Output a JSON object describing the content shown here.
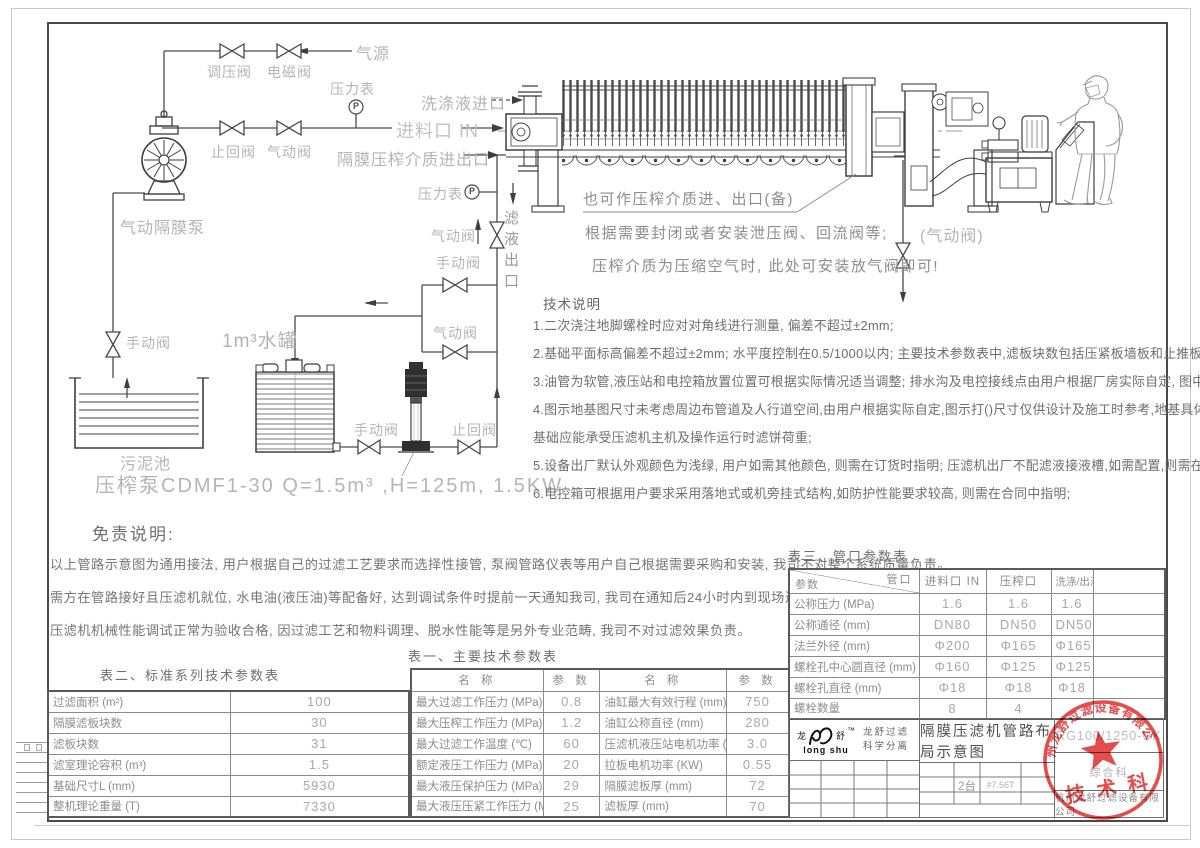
{
  "piping": {
    "gauge_letter": "P",
    "air_source": "气源",
    "regulator_valve": "调压阀",
    "solenoid_valve": "电磁阀",
    "pressure_gauge1": "压力表",
    "check_valve1": "止回阀",
    "pneumatic_valve1": "气动阀",
    "diaphragm_pump": "气动隔膜泵",
    "manual_valve_pool": "手动阀",
    "sludge_pool": "污泥池",
    "wash_inlet": "洗涤液进口",
    "feed_inlet": "进料口 IN",
    "membrane_port": "隔膜压榨介质进出口",
    "pressure_gauge2": "压力表",
    "pneumatic_valve2": "气动阀",
    "filtrate_outlet": "滤液出口",
    "manual_valve_branch": "手动阀",
    "pneumatic_valve_branch": "气动阀",
    "water_tank": "1m³水罐",
    "manual_valve_tank": "手动阀",
    "check_valve_bottom": "止回阀",
    "pneumatic_valve_right": "(气动阀)",
    "press_pump_spec": "压榨泵CDMF1-30   Q=1.5m³  ,H=125m, 1.5KW"
  },
  "callouts": {
    "c1": "也可作压榨介质进、出口(备)",
    "c2": "根据需要封闭或者安装泄压阀、回流阀等;",
    "c3": "压榨介质为压缩空气时, 此处可安装放气阀即可!"
  },
  "tech_notes": {
    "title": "技术说明",
    "lines": [
      "1.二次浇注地脚螺栓时应对对角线进行测量, 偏差不超过±2mm;",
      "2.基础平面标高偏差不超过±2mm; 水平度控制在0.5/1000以内; 主要技术参数表中,滤板块数包括压紧板墙板和止推板墙板;",
      "3.油管为软管,液压站和电控箱放置位置可根据实际情况适当调整;  排水沟及电控接线点由用户根据厂房实际自定, 图中不表示;",
      "4.图示地基图尺寸未考虑周边布管道及人行道空间,由用户根据实际自定,图示打()尺寸仅供设计及施工时参考,地基具体设计由用户负责,",
      "  基础应能承受压滤机主机及操作运行时滤饼荷重;",
      "5.设备出厂默认外观颜色为浅绿, 用户如需其他颜色, 则需在订货时指明; 压滤机出厂不配滤液接液槽,如需配置,则需在合同中指明。",
      "6.电控箱可根据用户要求采用落地式或机旁挂式结构,如防护性能要求较高, 则需在合同中指明;"
    ]
  },
  "disclaimer": {
    "title": "免责说明:",
    "lines": [
      "以上管路示意图为通用接法, 用户根据自己的过滤工艺要求而选择性接管, 泵阀管路仪表等用户自己根据需要采购和安装, 我司不对整个系统质量负责。",
      "需方在管路接好且压滤机就位, 水电油(液压油)等配备好, 达到调试条件时提前一天通知我司, 我司在通知后24小时内到现场进行压滤机各项动作调试,",
      "压滤机机械性能调试正常为验收合格, 因过滤工艺和物料调理、脱水性能等是另外专业范畴, 我司不对过滤效果负责。"
    ]
  },
  "table1": {
    "title": "表一、主要技术参数表",
    "headers": [
      "名  称",
      "参  数",
      "名  称",
      "参  数"
    ],
    "rows": [
      [
        "最大过滤工作压力 (MPa)",
        "0.8",
        "油缸最大有效行程 (mm)",
        "750"
      ],
      [
        "最大压榨工作压力 (MPa)",
        "1.2",
        "油缸公称直径 (mm)",
        "280"
      ],
      [
        "最大过滤工作温度 (℃)",
        "60",
        "压滤机液压站电机功率 (KW)",
        "3.0"
      ],
      [
        "额定液压工作压力 (MPa)",
        "20",
        "拉板电机功率 (KW)",
        "0.55"
      ],
      [
        "最大液压保护压力 (MPa)",
        "29",
        "隔膜滤板厚 (mm)",
        "72"
      ],
      [
        "最大液压压紧工作压力 (MPa)",
        "25",
        "滤板厚 (mm)",
        "70"
      ]
    ]
  },
  "table2": {
    "title": "表二、标准系列技术参数表",
    "rows": [
      [
        "过滤面积 (m²)",
        "100"
      ],
      [
        "隔膜滤板块数",
        "30"
      ],
      [
        "滤板块数",
        "31"
      ],
      [
        "滤室理论容积 (m³)",
        "1.5"
      ],
      [
        "基础尺寸L (mm)",
        "5930"
      ],
      [
        "整机理论重量 (T)",
        "7330"
      ]
    ]
  },
  "table3": {
    "title": "表三、管口参数表",
    "corner_top": "管口",
    "corner_bottom": "参数",
    "headers": [
      "进料口 IN",
      "压榨口",
      "洗涤/出液口",
      ""
    ],
    "rows": [
      [
        "公称压力 (MPa)",
        "1.6",
        "1.6",
        "1.6",
        ""
      ],
      [
        "公称通径 (mm)",
        "DN80",
        "DN50",
        "DN50",
        ""
      ],
      [
        "法兰外径 (mm)",
        "Φ200",
        "Φ165",
        "Φ165",
        ""
      ],
      [
        "螺栓孔中心圆直径 (mm)",
        "Φ160",
        "Φ125",
        "Φ125",
        ""
      ],
      [
        "螺栓孔直径 (mm)",
        "Φ18",
        "Φ18",
        "Φ18",
        ""
      ],
      [
        "螺栓数量",
        "8",
        "4",
        "",
        ""
      ]
    ]
  },
  "titleblock": {
    "logo_cn_left": "龙",
    "logo_cn_right": "舒",
    "logo_tm": "™",
    "logo_en": "long shu",
    "brand_line1": "龙舒过滤",
    "brand_line2": "科学分离",
    "title": "隔膜压滤机管路布局示意图",
    "drawing_no": "RG100/1250-UK",
    "dept": "综合科",
    "qty": "2台",
    "weight": "#7.56T",
    "company": "杭州龙舒过滤设备有限公司"
  },
  "stamp": {
    "ring_text": "杭州龙舒过滤设备有限公司",
    "center_text": "技 术 科",
    "color": "#e23333"
  }
}
